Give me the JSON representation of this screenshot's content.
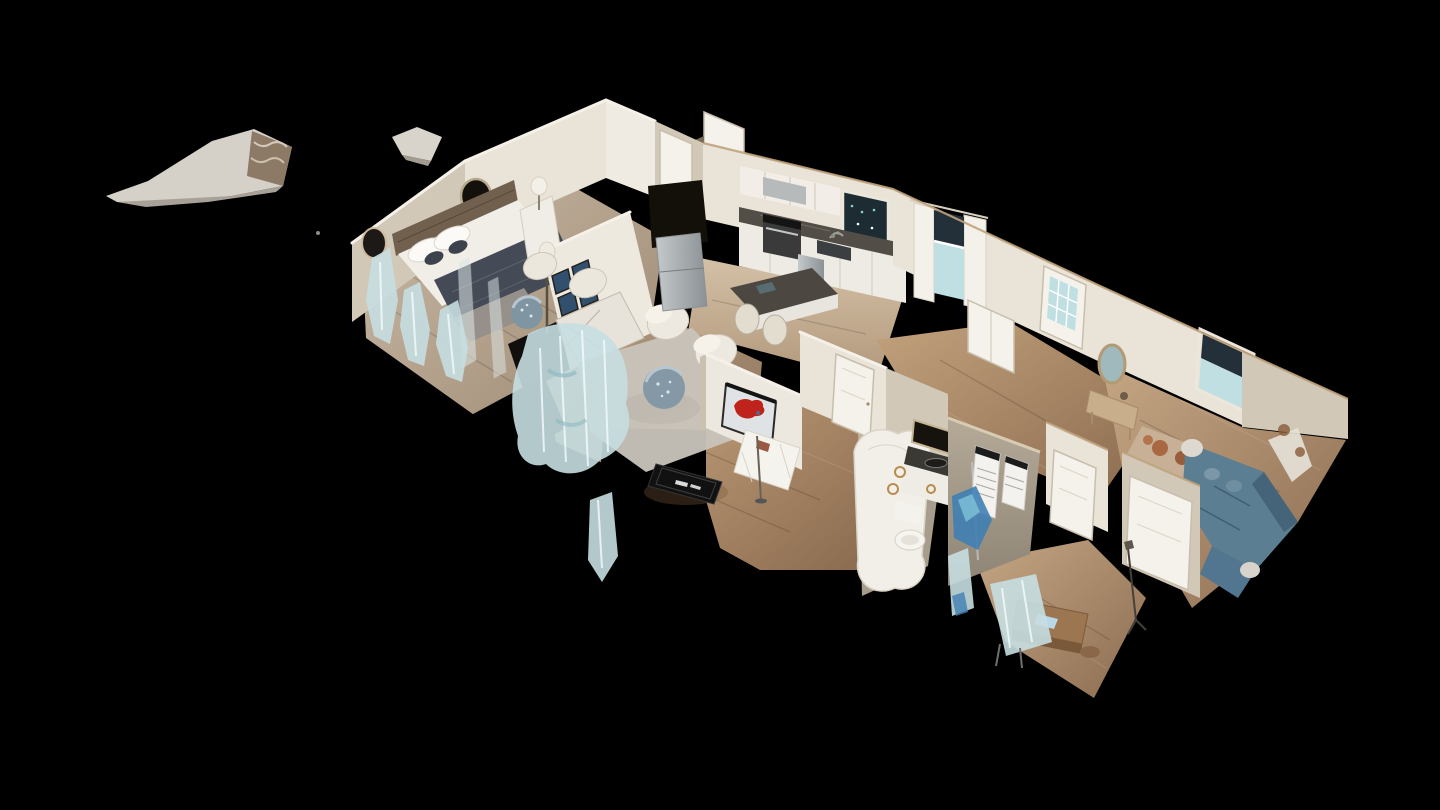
{
  "app": {
    "name": "3D virtual tour viewer",
    "view_mode": "dollhouse-cutaway",
    "visible_text": ""
  },
  "palette": {
    "background": "#000000",
    "wall_light": "#e9e3d8",
    "wall_shadow": "#d2c8b8",
    "wall_trim_tan": "#bfa37c",
    "floor_wood": "#b08a64",
    "floor_wood_pale": "#cbb89d",
    "rug_gray": "#c9c4bc",
    "counter_dark": "#524e47",
    "cabinet_white": "#edebe4",
    "bed_duvet_navy": "#454b56",
    "sofa_teal": "#5b7e92",
    "map_art_red": "#c0231b",
    "ghost_blue": "#c7dee1",
    "ghost_blue_deep": "#3f80b2",
    "stainless_steel": "#a9afb2",
    "glass_teal": "#bfdfe2",
    "doormat_black": "#111111"
  },
  "scene": {
    "description": "Cutaway dollhouse view of a single-story scanned home floating on a black background, seen from above at an angle",
    "rooms": [
      {
        "name": "master-bedroom",
        "contents": "bed with navy duvet, wood headboard, wall mirrors, nightstand lamp"
      },
      {
        "name": "entry-closet-hall",
        "contents": "white doors, front door"
      },
      {
        "name": "living-room",
        "contents": "cream armchairs, mosaic drum tables, gray rug, sideboard, gallery of four framed prints, floor lamp"
      },
      {
        "name": "kitchen",
        "contents": "white cabinets, range hood, stove, sink window, dark counters, stainless fridge, island with stools"
      },
      {
        "name": "dining-nook",
        "contents": "table with white cloth, red USA map wall art, black doormat"
      },
      {
        "name": "hallway",
        "contents": "white interior doors"
      },
      {
        "name": "bathroom",
        "contents": "dark-counter vanity, toilet, towel rings, shower, posters on gray wall"
      },
      {
        "name": "den",
        "contents": "teal sectional sofa, console with oval mirror, patterned rug, rear windows and glass back door"
      },
      {
        "name": "office-corner",
        "contents": "wood desk, chairs, floor lamp"
      }
    ],
    "artifacts": "floating ceiling mesh fragments and pale blue scan ghosts"
  }
}
